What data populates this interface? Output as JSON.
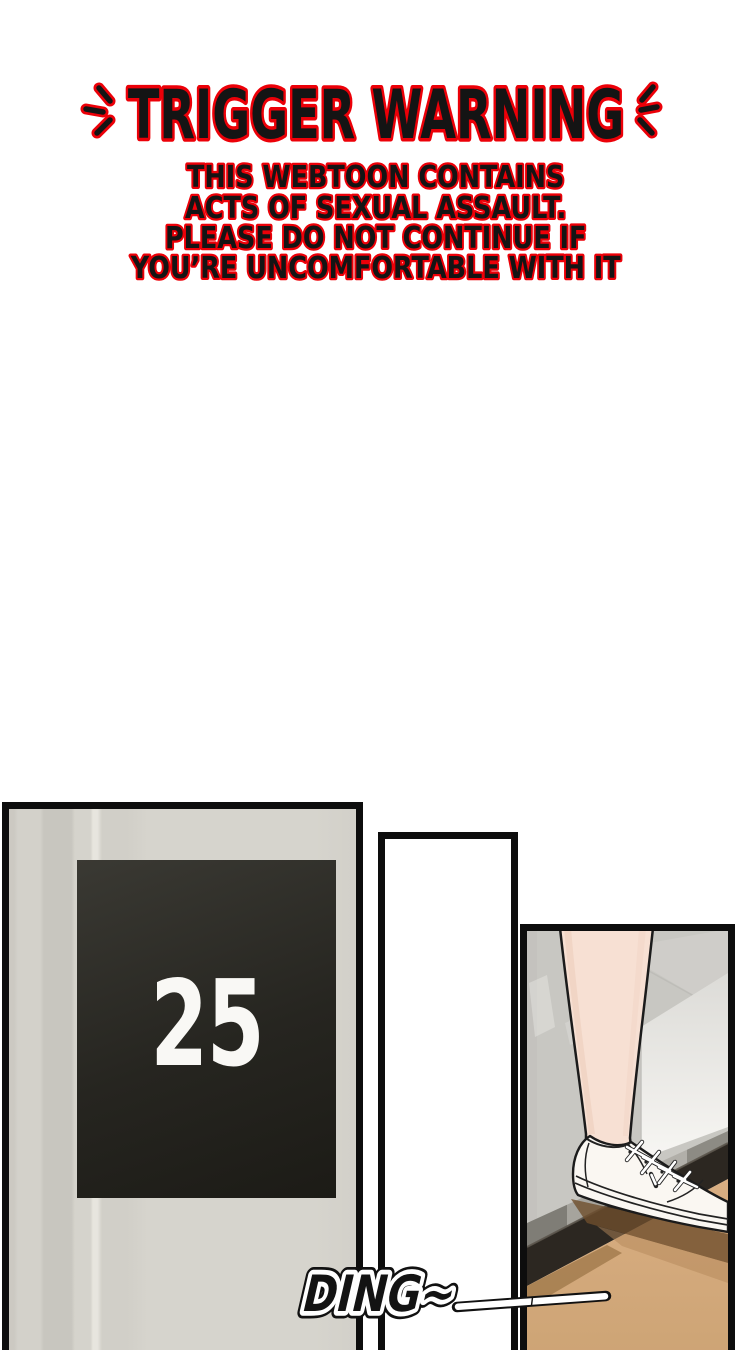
{
  "page": {
    "width_px": 750,
    "height_px": 1350,
    "background": "#ffffff"
  },
  "trigger_warning": {
    "title": "TRIGGER WARNING",
    "lines": [
      "THIS WEBTOON CONTAINS",
      "ACTS OF SEXUAL ASSAULT.",
      "PLEASE DO NOT CONTINUE IF",
      "YOU’RE UNCOMFORTABLE WITH IT"
    ],
    "text_color": "#141414",
    "outline_color": "#ec0008"
  },
  "comic": {
    "panel_border_color": "#0d0d0d",
    "floor_sign": {
      "number": "25",
      "bg_color": "#26251f",
      "text_color": "#f9f8f5"
    },
    "elevator_wall_color": "#d4d2cb",
    "scene": {
      "wall_color": "#c8c7c2",
      "door_jamb_color": "#f2f1ee",
      "sill_colors": [
        "#7f7d76",
        "#a6a49d",
        "#6f6d66",
        "#b1afa9",
        "#8d8b84"
      ],
      "threshold_color": "#2c2721",
      "floor_color": "#d5aa7d",
      "skin_color": "#f7e0d3",
      "shoe_color": "#faf7f2",
      "outline_color": "#1b1b1b"
    },
    "sfx": {
      "text": "DING~",
      "fill_color": "#131313",
      "halo_color": "#ffffff"
    }
  }
}
